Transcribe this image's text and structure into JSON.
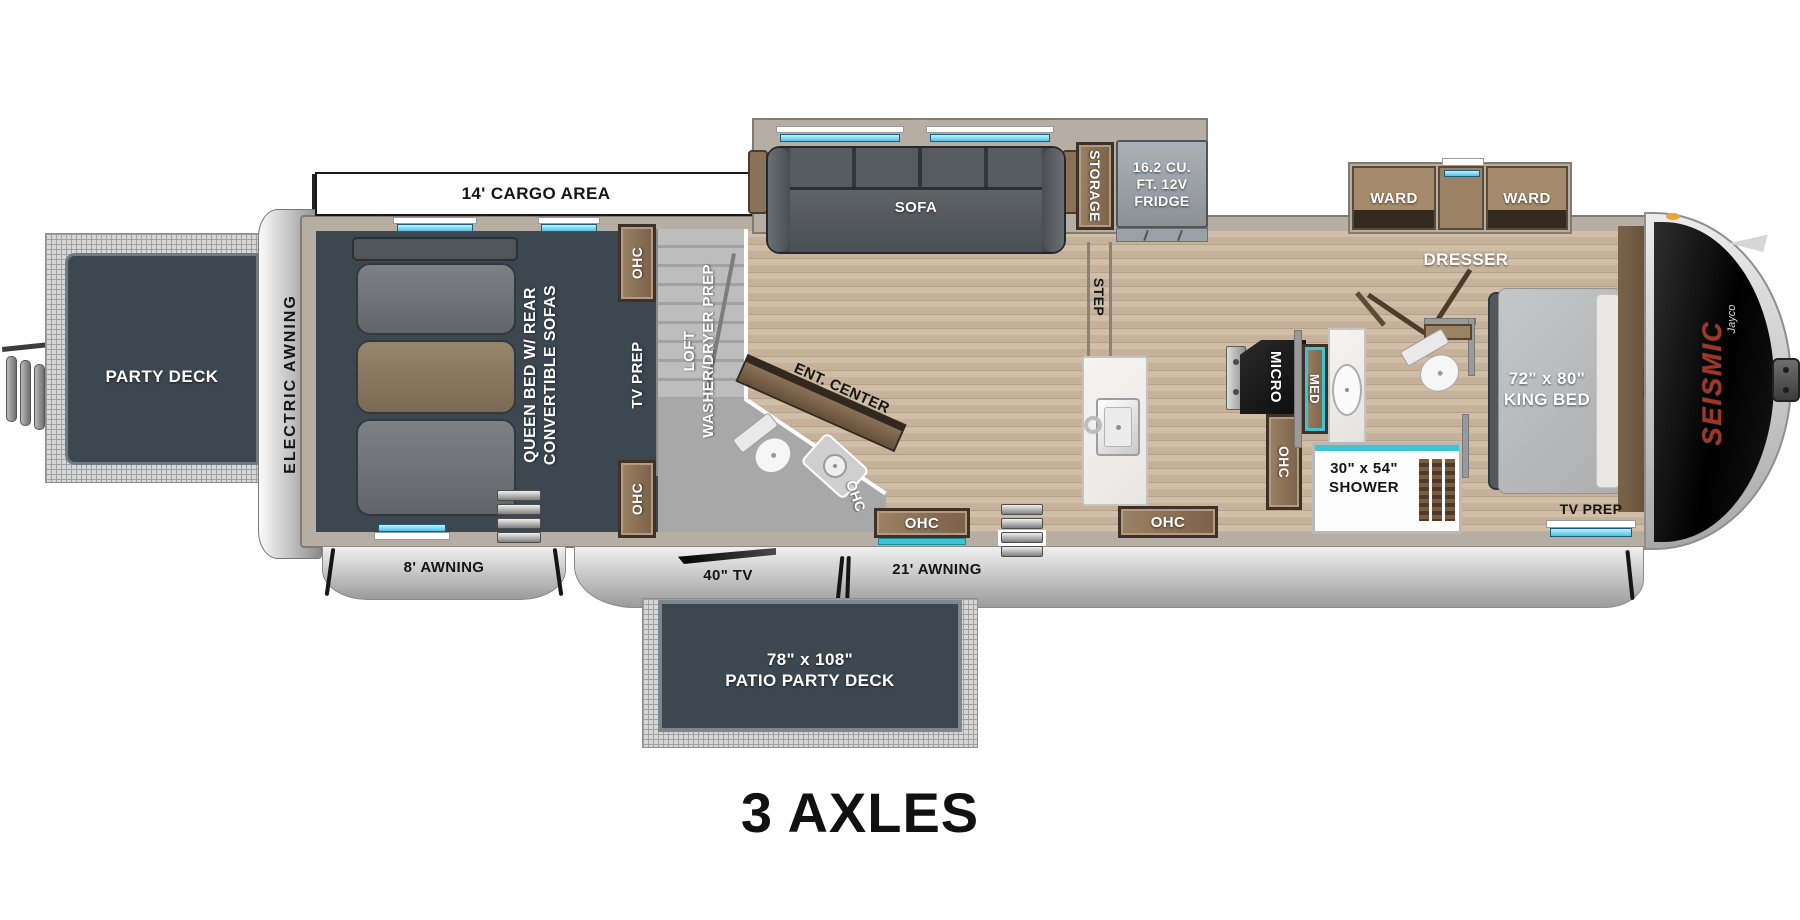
{
  "page": {
    "title": "3 AXLES"
  },
  "brand": {
    "name": "SEISMIC",
    "by": "Jayco"
  },
  "common": {
    "ohc": "OHC"
  },
  "exterior": {
    "electric_awning": "ELECTRIC AWNING",
    "cargo_area": "14' CARGO AREA",
    "awning_8": "8' AWNING",
    "tv_40": "40\" TV",
    "awning_21": "21' AWNING"
  },
  "rear_deck": {
    "label": "PARTY DECK"
  },
  "patio_deck": {
    "size": "78\" x 108\"",
    "label": "PATIO PARTY DECK"
  },
  "garage": {
    "bed_line1": "QUEEN BED W/ REAR",
    "bed_line2": "CONVERTIBLE SOFAS",
    "tv_prep": "TV PREP"
  },
  "loft": {
    "line1": "LOFT",
    "line2": "WASHER/DRYER PREP"
  },
  "living": {
    "ent_center": "ENT. CENTER",
    "sofa": "SOFA",
    "storage": "STORAGE",
    "fridge_line1": "16.2 CU.",
    "fridge_line2": "FT. 12V",
    "fridge_line3": "FRIDGE",
    "step": "STEP"
  },
  "kitchen": {
    "micro": "MICRO"
  },
  "bathroom": {
    "med": "MED",
    "shower_size": "30\" x 54\"",
    "shower": "SHOWER"
  },
  "bedroom": {
    "ward": "WARD",
    "dresser": "DRESSER",
    "bed_size": "72\" x 80\"",
    "bed": "KING BED",
    "tv_prep": "TV PREP"
  },
  "colors": {
    "slate": "#3d4750",
    "wood": "#c6b29a",
    "cabinet_wood": "#8a7257",
    "teal": "#3fc4d4",
    "brand_red": "#a33527"
  }
}
